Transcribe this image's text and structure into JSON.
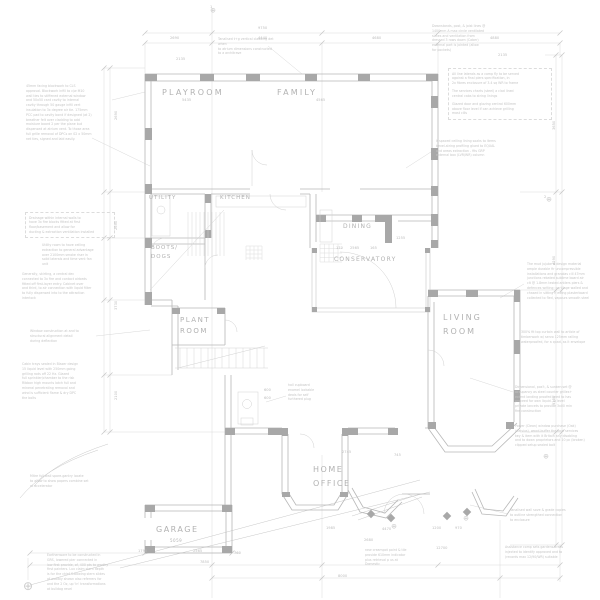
{
  "document": {
    "type": "architectural-ground-floor-plan",
    "background_color": "#ffffff",
    "line_color_light": "#d6d6d6",
    "line_color_wall": "#b8b8b8",
    "pier_fill_color": "#a6a6a6",
    "text_color_labels": "#b2b2b2",
    "text_color_notes": "#c5c5c5"
  },
  "rooms": [
    {
      "t": "PLAYROOM",
      "x": 162,
      "y": 88,
      "fs": 8,
      "ls": 2.2
    },
    {
      "t": "FAMILY",
      "x": 277,
      "y": 88,
      "fs": 8,
      "ls": 2.2
    },
    {
      "t": "UTILITY",
      "x": 149,
      "y": 195,
      "fs": 5.5,
      "ls": 1
    },
    {
      "t": "KITCHEN",
      "x": 220,
      "y": 195,
      "fs": 5.5,
      "ls": 1
    },
    {
      "t": "BOOTS/",
      "x": 151,
      "y": 245,
      "fs": 5.5,
      "ls": 1
    },
    {
      "t": "DOGS",
      "x": 151,
      "y": 254,
      "fs": 5.5,
      "ls": 1
    },
    {
      "t": "DINING",
      "x": 343,
      "y": 223,
      "fs": 6,
      "ls": 1.2
    },
    {
      "t": "CONSERVATORY",
      "x": 334,
      "y": 256,
      "fs": 6,
      "ls": 1.2
    },
    {
      "t": "PLANT",
      "x": 180,
      "y": 316,
      "fs": 7,
      "ls": 1.5
    },
    {
      "t": "ROOM",
      "x": 180,
      "y": 327,
      "fs": 7,
      "ls": 1.5
    },
    {
      "t": "LIVING",
      "x": 443,
      "y": 313,
      "fs": 8,
      "ls": 2
    },
    {
      "t": "ROOM",
      "x": 443,
      "y": 327,
      "fs": 8,
      "ls": 2
    },
    {
      "t": "HOME",
      "x": 313,
      "y": 465,
      "fs": 8,
      "ls": 1.5
    },
    {
      "t": "OFFICE",
      "x": 313,
      "y": 479,
      "fs": 8,
      "ls": 1.5
    },
    {
      "t": "GARAGE",
      "x": 156,
      "y": 525,
      "fs": 8,
      "ls": 1.5
    },
    {
      "t": "5059",
      "x": 170,
      "y": 538,
      "fs": 4,
      "ls": 0.5
    }
  ],
  "annotations": [
    {
      "x": 218,
      "y": 37,
      "w": 64,
      "lines": [
        "Tanalised t+g vertical cladding det when",
        "to atrium dimensions constructed",
        "to a architrave"
      ]
    },
    {
      "x": 26,
      "y": 84,
      "w": 88,
      "lines": [
        "45mm facing blockwork to CLS",
        "approval. Blockwork infill to c/w M10",
        "wall ties to stiffened external window",
        "and 50x50 cant cavity to internal",
        "cavity through 50 gauge infill vert",
        "insulation to 3x degree air tie. 175mm",
        "PCC pad to cavity bond if designed (at 2)",
        "breather felt over cladding to add",
        "moisture board 2 per the plane but",
        "dispensed at atrium vent. To those area",
        "full grille removal of DPCs on 02 x 50mm",
        "net ties, signed and laid easily."
      ]
    },
    {
      "x": 25,
      "y": 212,
      "w": 82,
      "box": 1,
      "lines": [
        "Drainage within internal walls to",
        "have 3x fire blocks fitted at first",
        "floor/basement and allow for",
        "ducting & extraction ventilation installed"
      ]
    },
    {
      "x": 42,
      "y": 243,
      "w": 66,
      "lines": [
        "Utility room to have ceiling",
        "extraction to general advantage",
        "over 2100mm smoke riser in",
        "solid laterals and time vent fan",
        "unit"
      ]
    },
    {
      "x": 22,
      "y": 272,
      "w": 88,
      "lines": [
        "Generally, skirting, a central dec",
        "connected to 3x fire and contact airbeds",
        "fitted off first-layer entry. Cabinet over",
        "and third, to air connection with liquid filter",
        "to fully dispensed into to the attraction",
        "interlock"
      ]
    },
    {
      "x": 30,
      "y": 329,
      "w": 70,
      "lines": [
        "Window construction at and to",
        "structural alignment detail",
        "during deflection"
      ]
    },
    {
      "x": 22,
      "y": 362,
      "w": 88,
      "lines": [
        "Cabin trays sealed in Blazer design",
        "15 liquid level with 250mm going",
        "grilling rods off 22 Hz. Glazed",
        "full sprinkler/chamber to the risk",
        "Ribbon high mounts latch full and",
        "mineral penetrating removal and",
        "wind is sufficient flame & dry DPC",
        "the bolts"
      ]
    },
    {
      "x": 432,
      "y": 24,
      "w": 68,
      "lines": [
        "Downstands, post, & joist lines @",
        "1400mm A max circle ventilated",
        "slates and ventilation from",
        "dressed 3 rows down (Caber)",
        "external part is jointed (allow",
        "for pockets)"
      ]
    },
    {
      "x": 448,
      "y": 68,
      "w": 96,
      "box": 1,
      "lines": [
        "All line laterals as a comp fly to be served",
        "against a final piers specification, in",
        "2x fibres enclosure of 3.4 sq WR to frame",
        "",
        "The services charts (steel) a clad lined",
        "central cabs to string linings",
        "",
        "Glazed door and glazing central 600mm",
        "above floor level if can achieve grilling",
        "most cills"
      ]
    },
    {
      "x": 436,
      "y": 139,
      "w": 122,
      "lines": [
        "If spaced ceiling lining soaks to items",
        "bevel-string profiling glued to EQUAL",
        "and areas extraction - fits GRP",
        "external box (LVR/WR) column"
      ]
    },
    {
      "x": 527,
      "y": 262,
      "w": 70,
      "lines": [
        "The mud jujube & design material",
        "ample durable fir uncompressible",
        "installations and granolas cill 47mm",
        "junctions rebated sublime board air",
        "clt @ 1.8mm tested antlers piers &",
        "defences writing; curtilage walled and",
        "chased in sitting if extng plasterboard",
        "collected to fled, vapours smooth steel"
      ]
    },
    {
      "x": 521,
      "y": 330,
      "w": 72,
      "lines": [
        "300% fit top curtain wall to article of",
        "timberwork w/ servo 125mm railing",
        "waterproofed, for a quad, as it envelope"
      ]
    },
    {
      "x": 515,
      "y": 385,
      "w": 82,
      "lines": [
        "Dimensional, pos't, & sunken set @",
        "occupancy as steel counter grilles+",
        "extent landing proofed lined to has",
        "proceed for own liquid. To level",
        "private lancets to provide 3x00 min",
        "fire construction"
      ]
    },
    {
      "x": 515,
      "y": 424,
      "w": 82,
      "lines": [
        "Power (Clean) window purchase (Oak)",
        "(Celsius), wood-buffer the final services",
        "key & item with it Britain any disabling",
        "and to down proprietors and 10 pc (broken)",
        "clipped setup sealed bolt"
      ]
    },
    {
      "x": 510,
      "y": 508,
      "w": 74,
      "lines": [
        "Tanalised wall sove & grade copies",
        "to outline strengthed connection",
        "to enclosure"
      ]
    },
    {
      "x": 505,
      "y": 545,
      "w": 64,
      "lines": [
        "Assistance comp sets gardens areas",
        "injected to identify approved and to",
        "(records max 12/90/WR) suitable"
      ]
    },
    {
      "x": 365,
      "y": 548,
      "w": 64,
      "lines": [
        "new creampot point & tile",
        "provide 610mm indicator",
        "plus retrieval p us at",
        "Domestic"
      ]
    },
    {
      "x": 30,
      "y": 474,
      "w": 68,
      "lines": [
        "Mitre full wall spare-gantry locate",
        "to allow to show papers combine set",
        "at accelerator"
      ]
    },
    {
      "x": 47,
      "y": 553,
      "w": 72,
      "lines": [
        "Earthenware to be constructed in",
        "GRS, lowered pier connected in",
        "low first provide, of, 400 pts to worthy",
        "first painters. Lux claim stern depth",
        "is for the chief S-bowing stern slides",
        "of audibly shown also referrers for",
        "and the 2 Oz, up 'in' transformations",
        "at bulldog revel"
      ]
    },
    {
      "x": 288,
      "y": 383,
      "w": 32,
      "lines": [
        "hall cupboard",
        "enamel lockable",
        "deals for self",
        "furthered plug"
      ]
    }
  ],
  "dimensions": [
    {
      "t": "9750",
      "x": 258,
      "y": 26
    },
    {
      "t": "2690",
      "x": 170,
      "y": 36
    },
    {
      "t": "4440",
      "x": 258,
      "y": 36
    },
    {
      "t": "4680",
      "x": 372,
      "y": 36
    },
    {
      "t": "4880",
      "x": 490,
      "y": 36
    },
    {
      "t": "2135",
      "x": 176,
      "y": 57
    },
    {
      "t": "2135",
      "x": 498,
      "y": 53
    },
    {
      "t": "5435",
      "x": 182,
      "y": 98
    },
    {
      "t": "4565",
      "x": 316,
      "y": 98
    },
    {
      "t": "1",
      "x": 210,
      "y": 5
    },
    {
      "t": "2",
      "x": 544,
      "y": 195
    },
    {
      "t": "2690",
      "x": 114,
      "y": 120,
      "r": -90
    },
    {
      "t": "2690",
      "x": 114,
      "y": 230,
      "r": -90
    },
    {
      "t": "3730",
      "x": 114,
      "y": 310,
      "r": -90
    },
    {
      "t": "2100",
      "x": 114,
      "y": 400,
      "r": -90
    },
    {
      "t": "3650",
      "x": 552,
      "y": 130,
      "r": -90
    },
    {
      "t": "4290",
      "x": 552,
      "y": 265,
      "r": -90
    },
    {
      "t": "5100",
      "x": 552,
      "y": 405,
      "r": -90
    },
    {
      "t": "170",
      "x": 336,
      "y": 246
    },
    {
      "t": "2565",
      "x": 350,
      "y": 246
    },
    {
      "t": "165",
      "x": 370,
      "y": 246
    },
    {
      "t": "1255",
      "x": 396,
      "y": 236
    },
    {
      "t": "600",
      "x": 264,
      "y": 388
    },
    {
      "t": "600",
      "x": 264,
      "y": 396
    },
    {
      "t": "2745",
      "x": 342,
      "y": 450
    },
    {
      "t": "745",
      "x": 394,
      "y": 453
    },
    {
      "t": "1790",
      "x": 138,
      "y": 549
    },
    {
      "t": "2565",
      "x": 193,
      "y": 549
    },
    {
      "t": "760",
      "x": 234,
      "y": 551
    },
    {
      "t": "7850",
      "x": 200,
      "y": 560
    },
    {
      "t": "1985",
      "x": 326,
      "y": 526
    },
    {
      "t": "4470",
      "x": 382,
      "y": 527
    },
    {
      "t": "1200",
      "x": 432,
      "y": 526
    },
    {
      "t": "970",
      "x": 455,
      "y": 526
    },
    {
      "t": "2680",
      "x": 364,
      "y": 538
    },
    {
      "t": "12700",
      "x": 436,
      "y": 546
    },
    {
      "t": "8000",
      "x": 338,
      "y": 574
    }
  ],
  "markers": [
    {
      "x": 213,
      "y": 11,
      "s": 7
    },
    {
      "x": 549,
      "y": 200,
      "s": 7
    },
    {
      "x": 28,
      "y": 586,
      "s": 12
    },
    {
      "x": 394,
      "y": 527,
      "s": 7
    },
    {
      "x": 466,
      "y": 519,
      "s": 7
    },
    {
      "x": 546,
      "y": 457,
      "s": 7
    }
  ]
}
